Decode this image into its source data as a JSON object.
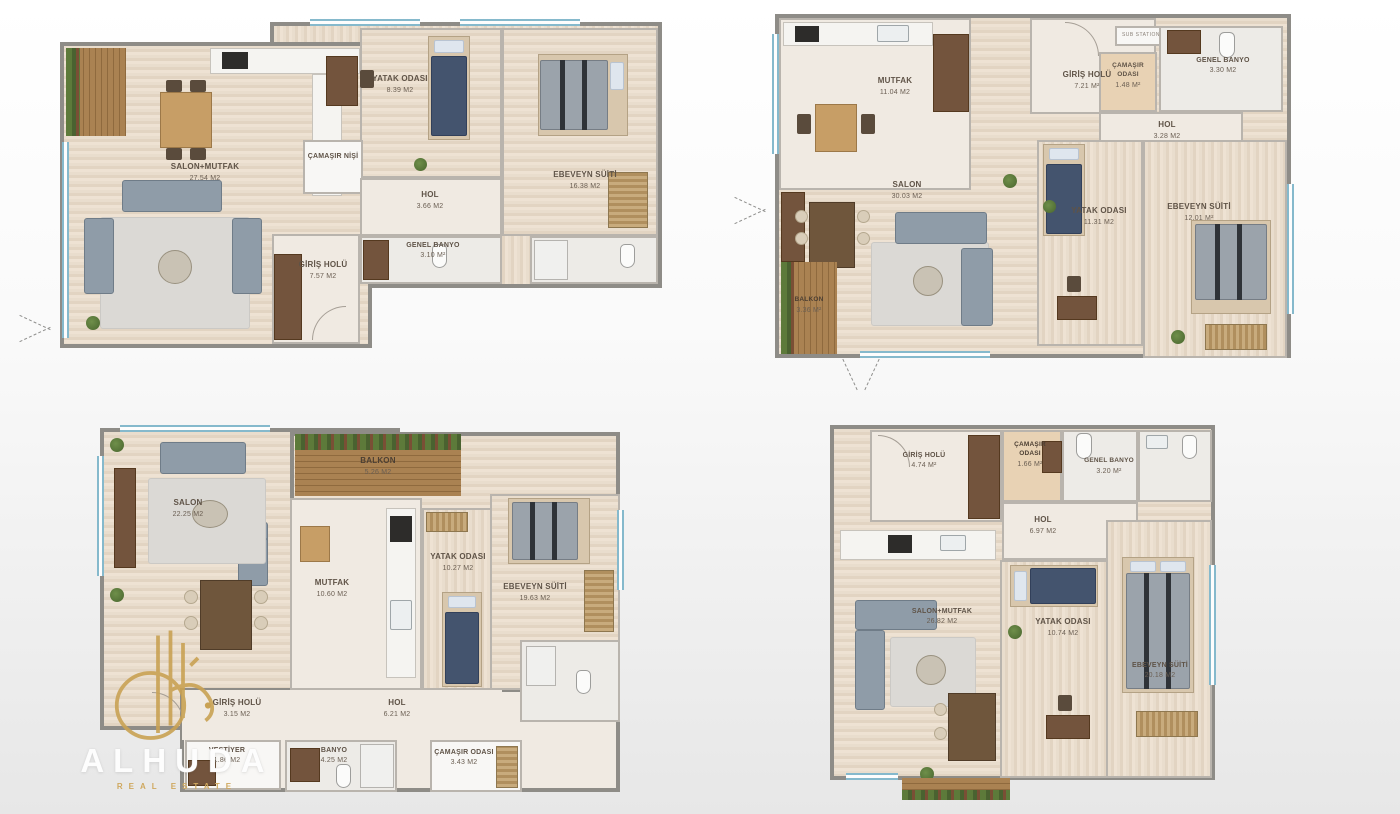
{
  "watermark": {
    "brand": "ALHUDA",
    "tagline": "REAL ESTATE",
    "gold": "#c9a254"
  },
  "plans": [
    {
      "id": "top-left",
      "rooms": [
        {
          "name": "SALON+MUTFAK",
          "area": "27.54 m2"
        },
        {
          "name": "YATAK ODASI",
          "area": "8.39 m2"
        },
        {
          "name": "ÇAMAŞIR NİŞİ",
          "area": ""
        },
        {
          "name": "HOL",
          "area": "3.66 m2"
        },
        {
          "name": "EBEVEYN SÜİTİ",
          "area": "16.38 m2"
        },
        {
          "name": "GENEL BANYO",
          "area": "3.10 m²"
        },
        {
          "name": "GİRİŞ HOLÜ",
          "area": "7.57 m2"
        }
      ]
    },
    {
      "id": "top-right",
      "rooms": [
        {
          "name": "MUTFAK",
          "area": "11.04 m2"
        },
        {
          "name": "GİRİŞ HOLÜ",
          "area": "7.21 m²"
        },
        {
          "name": "SUB STATION",
          "area": ""
        },
        {
          "name": "ÇAMAŞIR ODASI",
          "area": "1.48 m²"
        },
        {
          "name": "GENEL BANYO",
          "area": "3.30 m2"
        },
        {
          "name": "HOL",
          "area": "3.28 m2"
        },
        {
          "name": "SALON",
          "area": "30.03 m2"
        },
        {
          "name": "YATAK ODASI",
          "area": "11.31 m2"
        },
        {
          "name": "EBEVEYN SÜİTİ",
          "area": "12.01 m²"
        },
        {
          "name": "BALKON",
          "area": "3.36 m²"
        }
      ]
    },
    {
      "id": "bottom-left",
      "rooms": [
        {
          "name": "SALON",
          "area": "22.25 m2"
        },
        {
          "name": "BALKON",
          "area": "5.26 m2"
        },
        {
          "name": "MUTFAK",
          "area": "10.60 m2"
        },
        {
          "name": "YATAK ODASI",
          "area": "10.27 m2"
        },
        {
          "name": "EBEVEYN SÜİTİ",
          "area": "19.63 m2"
        },
        {
          "name": "GİRİŞ HOLÜ",
          "area": "3.15 m2"
        },
        {
          "name": "HOL",
          "area": "6.21 m2"
        },
        {
          "name": "VESTİYER",
          "area": "1.86 m2"
        },
        {
          "name": "BANYO",
          "area": "4.25 m2"
        },
        {
          "name": "ÇAMAŞIR ODASI",
          "area": "3.43 m2"
        }
      ]
    },
    {
      "id": "bottom-right",
      "rooms": [
        {
          "name": "GİRİŞ HOLÜ",
          "area": "4.74 m²"
        },
        {
          "name": "ÇAMAŞIR ODASI",
          "area": "1.66 m²"
        },
        {
          "name": "GENEL BANYO",
          "area": "3.20 m²"
        },
        {
          "name": "HOL",
          "area": "6.97 m2"
        },
        {
          "name": "SALON+MUTFAK",
          "area": "26.82 m2"
        },
        {
          "name": "YATAK ODASI",
          "area": "10.74 m2"
        },
        {
          "name": "EBEVEYN SÜİTİ",
          "area": "20.18 m2"
        }
      ]
    }
  ]
}
